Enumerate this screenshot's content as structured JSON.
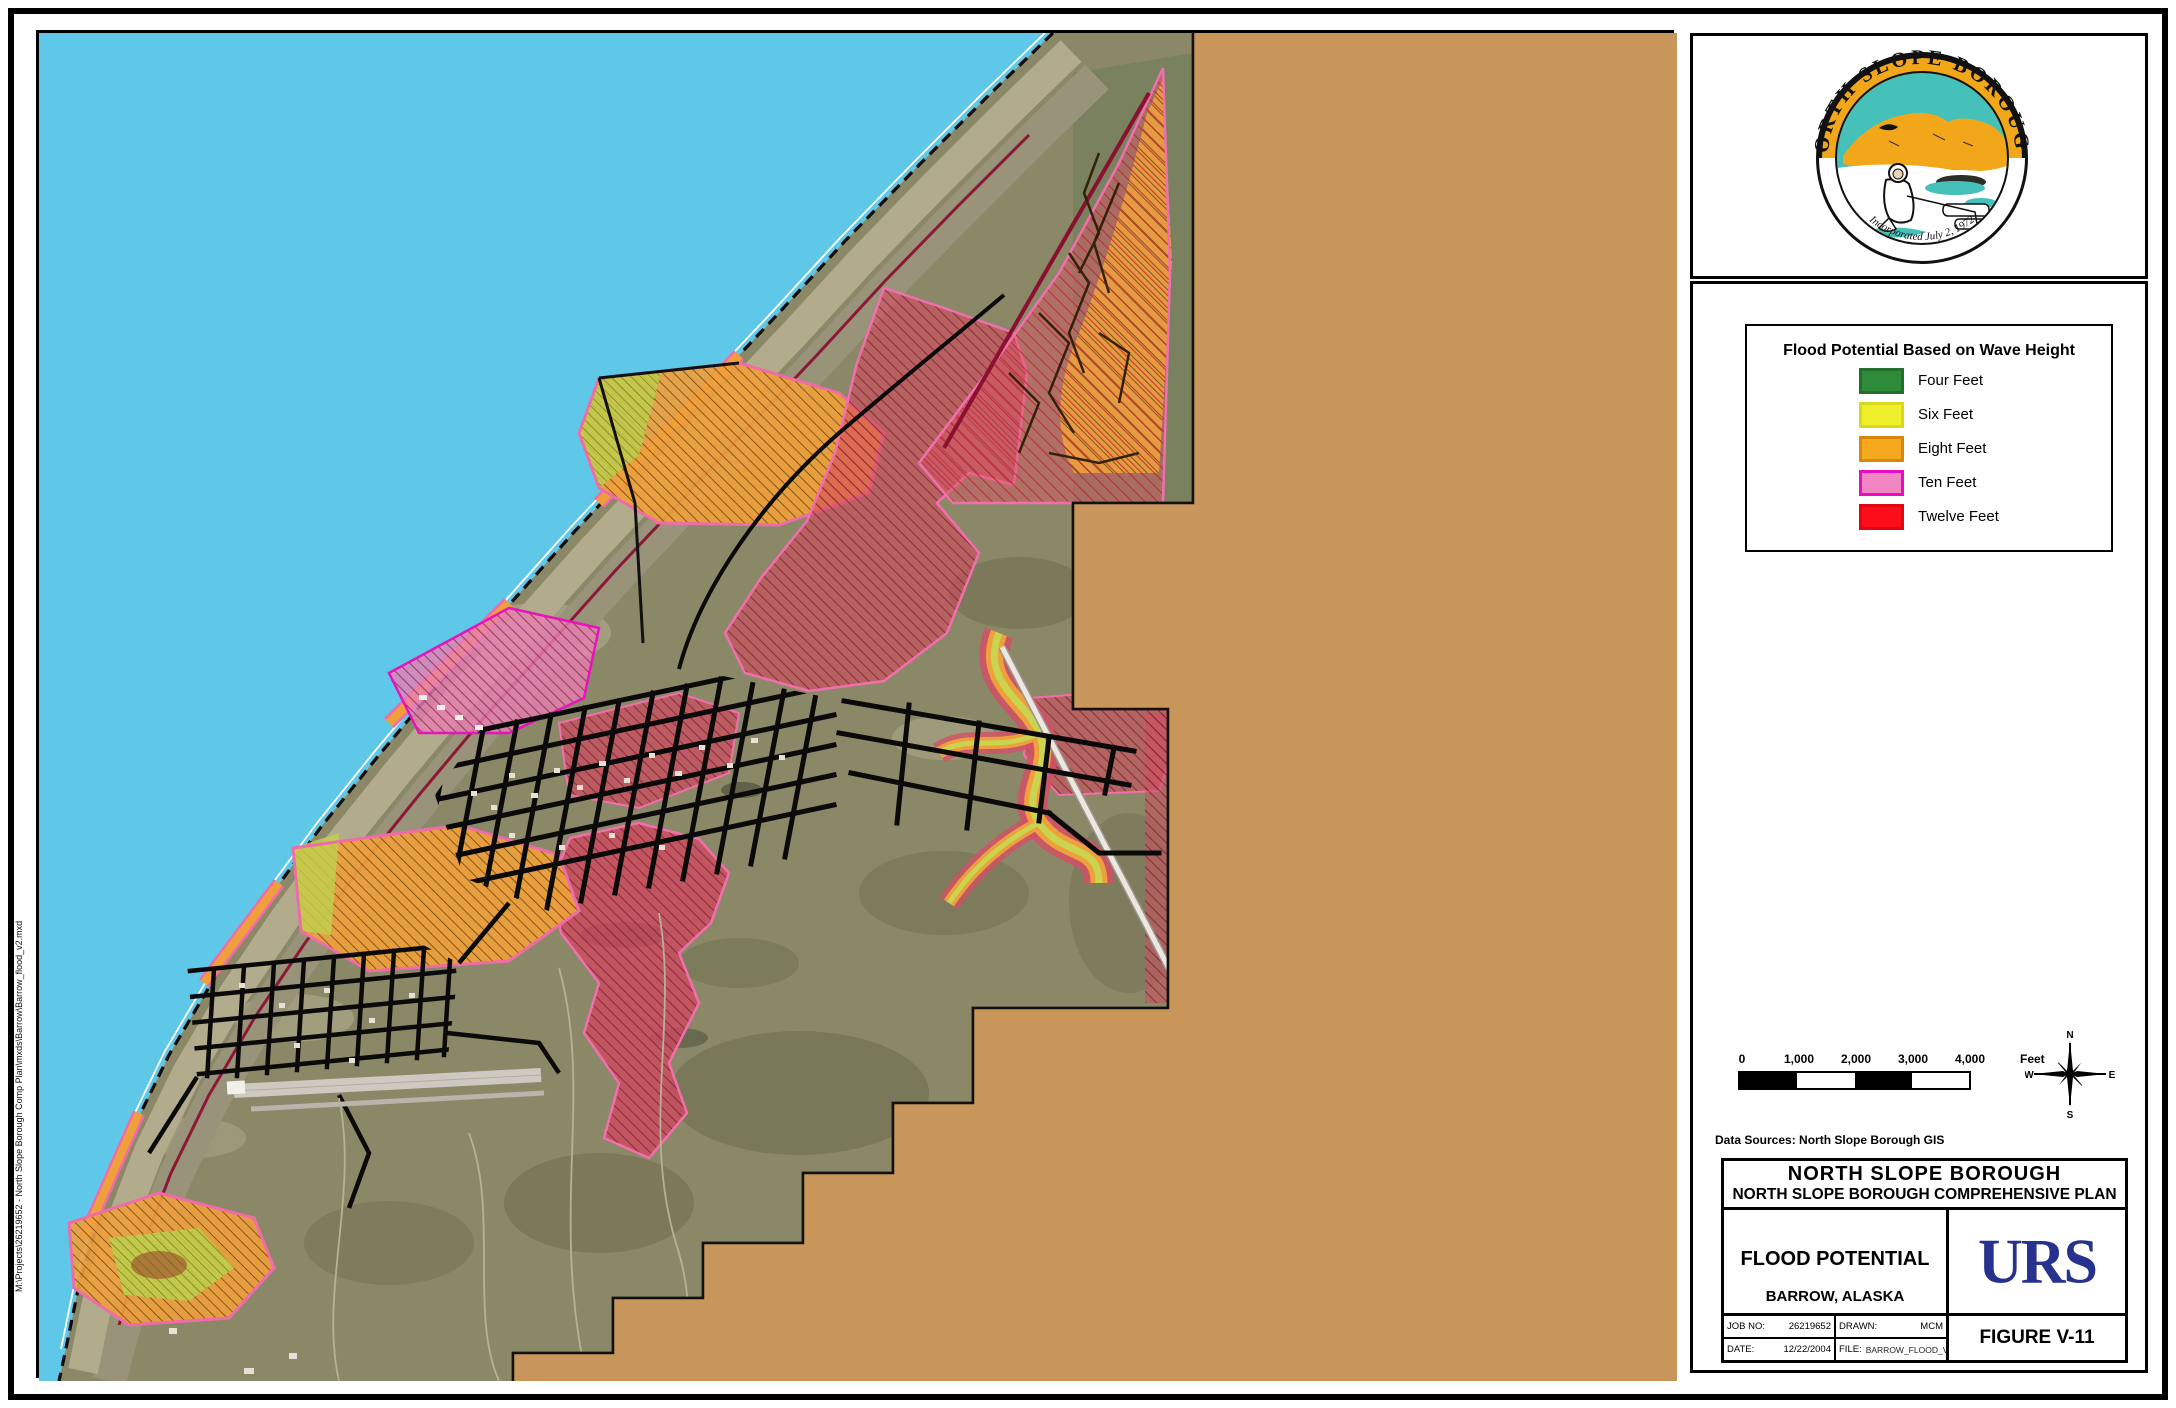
{
  "map": {
    "file_path_note": "M:\\Projects\\26219652 - North Slope Borough Comp Plan\\mxds\\Barrow\\Barrow_flood_v2.mxd",
    "colors": {
      "ocean": "#5FC8E8",
      "background_tan": "#C8955B",
      "land_olive": "#8B8867",
      "beach": "#A89F80"
    }
  },
  "sidebar": {
    "seal": {
      "ring_text": "NORTH SLOPE BOROUGH",
      "bottom_text": "Incorporated July 2, 1972",
      "gold": "#F2A71B",
      "teal": "#46C1BA"
    },
    "legend": {
      "title": "Flood Potential Based on Wave Height",
      "items": [
        {
          "label": "Four Feet",
          "fill": "#2E8B3A",
          "border": "#23702E"
        },
        {
          "label": "Six Feet",
          "fill": "#EFEF2C",
          "border": "#D8D81E"
        },
        {
          "label": "Eight Feet",
          "fill": "#F6A91F",
          "border": "#D8860E"
        },
        {
          "label": "Ten Feet",
          "fill": "#F186C3",
          "border": "#E90DBF"
        },
        {
          "label": "Twelve Feet",
          "fill": "#FB0D19",
          "border": "#E00810"
        }
      ]
    },
    "scalebar": {
      "ticks": [
        "0",
        "1,000",
        "2,000",
        "3,000",
        "4,000"
      ],
      "unit": "Feet"
    },
    "compass": {
      "n": "N",
      "s": "S",
      "e": "E",
      "w": "W"
    },
    "data_sources": "Data Sources: North Slope Borough GIS",
    "title_block": {
      "line1": "NORTH SLOPE BOROUGH",
      "line2": "NORTH SLOPE BOROUGH COMPREHENSIVE PLAN",
      "map_title": "FLOOD POTENTIAL",
      "city": "BARROW, ALASKA",
      "company": "URS",
      "figure": "FIGURE V-11",
      "job_label": "JOB NO:",
      "job_value": "26219652",
      "drawn_label": "DRAWN:",
      "drawn_value": "MCM",
      "date_label": "DATE:",
      "date_value": "12/22/2004",
      "file_label": "FILE:",
      "file_value": "BARROW_FLOOD_V2.MXD"
    }
  }
}
